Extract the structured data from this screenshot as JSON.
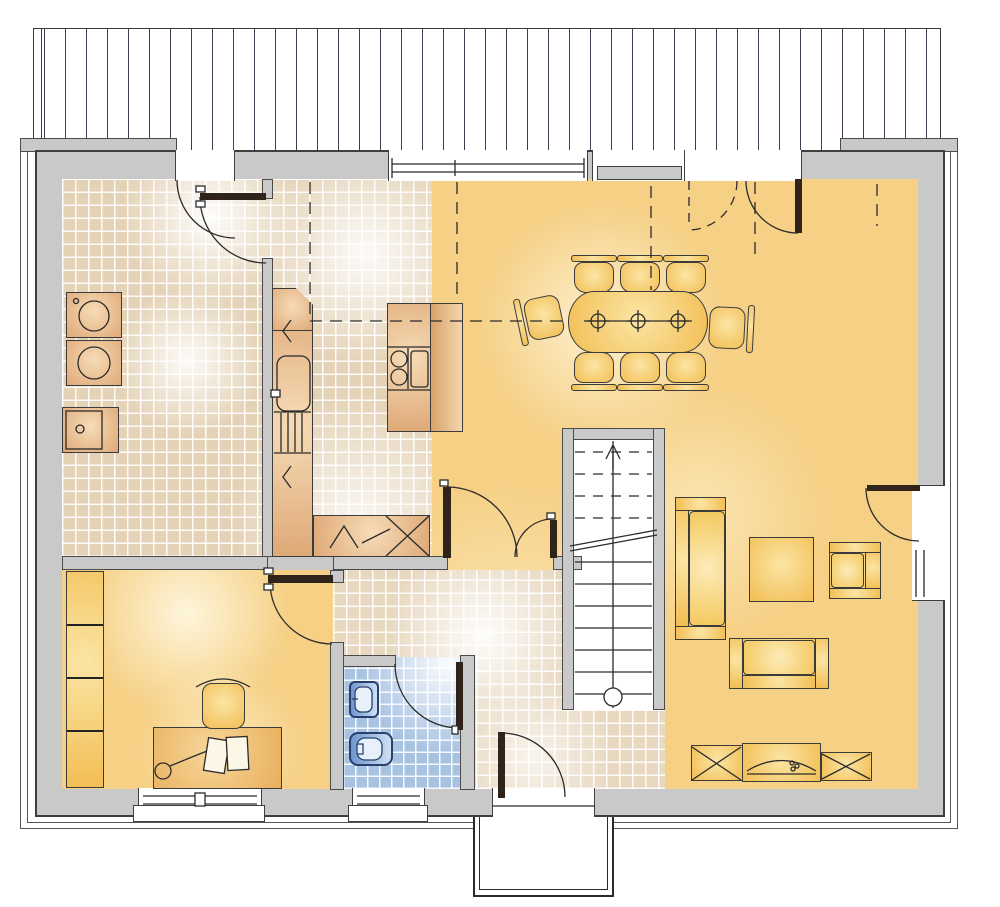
{
  "plan": {
    "rooms": {
      "kochen": {
        "name": "Kochen",
        "area": "12.00 m²"
      },
      "hwr": {
        "name": "HWR",
        "area": "15.03 m²"
      },
      "wohnen": {
        "name": "Wohnen/Essen",
        "area": "46.18 m²"
      },
      "buero": {
        "name": "Büro",
        "area": "11.66 m²"
      },
      "diele": {
        "name": "Diele",
        "area": "7.96 m²"
      },
      "wc": {
        "name": "WC",
        "area": "3.00 m²"
      }
    },
    "icons": {
      "entrance_arrow": "▲"
    },
    "colors": {
      "wall": "#C9C9C9",
      "line": "#2b2b2b",
      "deck_line": "#483852",
      "tile": "#E4D2B6",
      "tile_diele": "#E8D8C0",
      "wc_tile": "#A8C2E2",
      "floor_yellow": "#F6D085",
      "furn_tan_light": "#F6DCB7",
      "furn_tan_dark": "#DFA877",
      "furn_yellow_light": "#FBE5A4",
      "furn_yellow_dark": "#F2BE54",
      "leaf": "#30241A",
      "wc_fixture": "#27406E"
    }
  }
}
